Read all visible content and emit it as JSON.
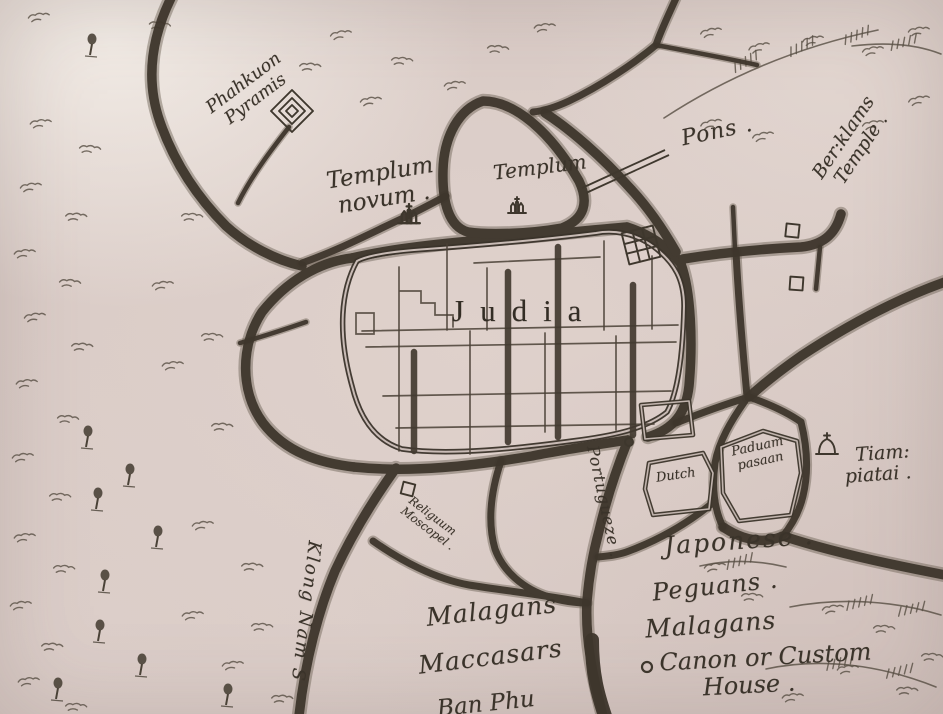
{
  "palette": {
    "paper": "#daccc7",
    "paper_highlight": "#f3ede7",
    "ink": "#3e362c",
    "ink_light": "#6a6053"
  },
  "labels": {
    "phahkuon": {
      "line1": "Phahkuon",
      "line2": "Pyramis"
    },
    "templum_novum": {
      "line1": "Templum",
      "line2": "novum ."
    },
    "templum": {
      "text": "Templum"
    },
    "pons": {
      "text": "Pons ."
    },
    "berklams": {
      "line1": "Ber:klams",
      "line2": "Temple ."
    },
    "judia": {
      "text": "Judia"
    },
    "portugueze": {
      "text": "Portugueze ."
    },
    "dutch": {
      "text": "Dutch"
    },
    "paduam": {
      "line1": "Paduam",
      "line2": "pasaan"
    },
    "tiam": {
      "line1": "Tiam:",
      "line2": "piatai ."
    },
    "japonese": {
      "text": "Japonese ."
    },
    "peguans": {
      "text": "Peguans ."
    },
    "malagans_right": {
      "text": "Malagans"
    },
    "canon": {
      "line1": "Canon or Custom",
      "line2": "House ."
    },
    "malagans_left": {
      "text": "Malagans"
    },
    "maccasars": {
      "text": "Maccasars"
    },
    "ban_phu": {
      "text": "Ban Phu"
    },
    "klong_nam": {
      "text": "Klong Nam S"
    },
    "religuum": {
      "line1": "Religuum",
      "line2": "Moscopel ."
    }
  },
  "icons": {
    "pyramis_icon": "concentric-diamond",
    "temple_icon": "small-pagoda",
    "fort_icon": "hatched-square",
    "dome_icon": "domed-shrine",
    "building_marker": "small-square",
    "junction_marker": "small-circle",
    "custom_house_marker": "small-circle",
    "bridge": "double-line",
    "tree": "leafy-tree",
    "hill": "squiggle-hatch"
  }
}
